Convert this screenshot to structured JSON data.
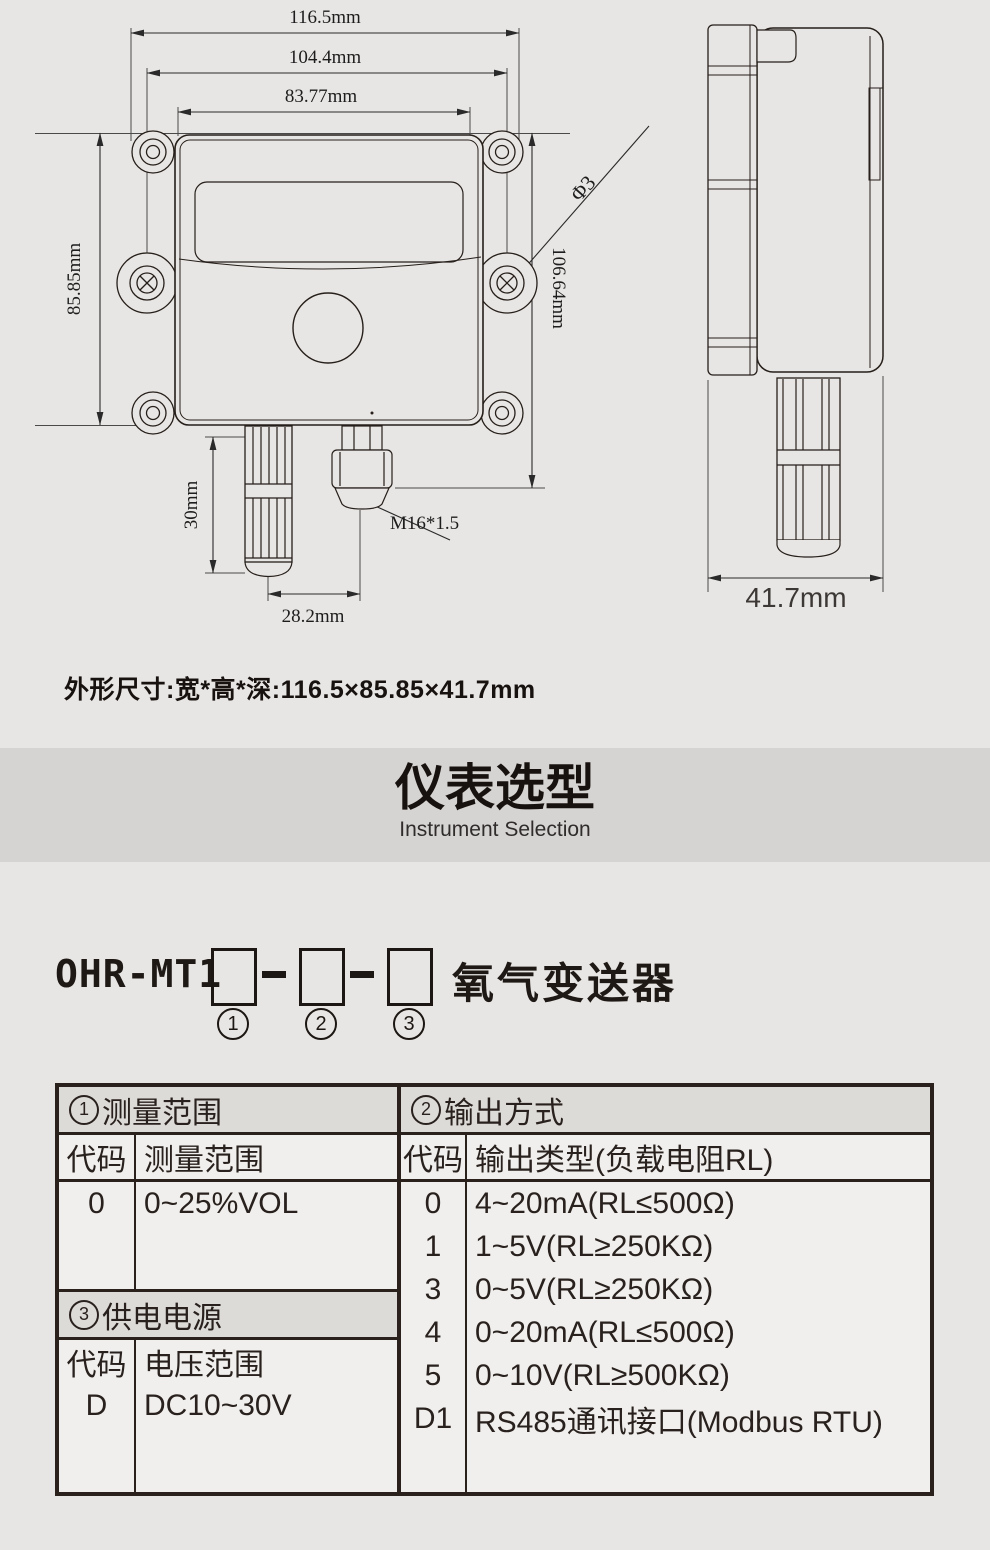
{
  "colors": {
    "page_bg": "#e8e6e4",
    "band_bg": "#d6d4d2",
    "table_border": "#2b211c",
    "cell_bg": "#f0efed",
    "header_bg": "#dddbd8"
  },
  "drawing": {
    "front_view": {
      "dim_width_overall": "116.5mm",
      "dim_width_mount_holes": "104.4mm",
      "dim_width_inner": "83.77mm",
      "dim_height": "85.85mm",
      "dim_height_total": "106.64mm",
      "dim_probe_length": "30mm",
      "dim_probe_offset": "28.2mm",
      "thread_label": "M16*1.5",
      "hole_label": "Φ3"
    },
    "side_view": {
      "dim_depth": "41.7mm"
    }
  },
  "size_note": "外形尺寸:宽*高*深:116.5×85.85×41.7mm",
  "section_header": {
    "title_zh": "仪表选型",
    "title_en": "Instrument Selection"
  },
  "model_line": {
    "prefix": "OHR-MT1",
    "product_name": "氧气变送器",
    "positions": [
      "1",
      "2",
      "3"
    ]
  },
  "selection_table": {
    "range": {
      "header_num": "1",
      "header_label": "测量范围",
      "col_code": "代码",
      "col_label": "测量范围",
      "rows": [
        {
          "code": "0",
          "label": "0~25%VOL"
        }
      ]
    },
    "output": {
      "header_num": "2",
      "header_label": "输出方式",
      "col_code": "代码",
      "col_label": "输出类型(负载电阻RL)",
      "rows": [
        {
          "code": "0",
          "label": "4~20mA(RL≤500Ω)"
        },
        {
          "code": "1",
          "label": "1~5V(RL≥250KΩ)"
        },
        {
          "code": "3",
          "label": "0~5V(RL≥250KΩ)"
        },
        {
          "code": "4",
          "label": "0~20mA(RL≤500Ω)"
        },
        {
          "code": "5",
          "label": "0~10V(RL≥500KΩ)"
        },
        {
          "code": "D1",
          "label": "RS485通讯接口(Modbus RTU)"
        }
      ]
    },
    "power": {
      "header_num": "3",
      "header_label": "供电电源",
      "col_code": "代码",
      "col_label": "电压范围",
      "rows": [
        {
          "code": "D",
          "label": "DC10~30V"
        }
      ]
    }
  }
}
